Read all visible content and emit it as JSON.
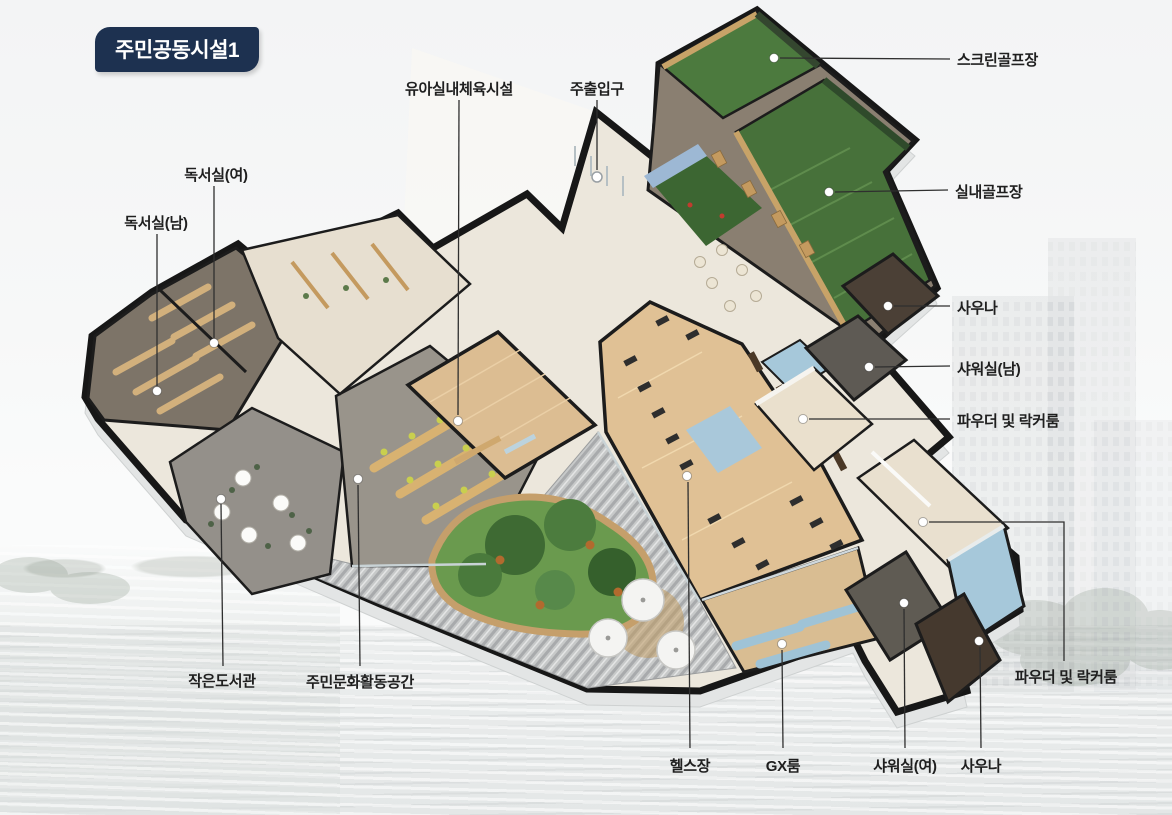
{
  "title_badge": {
    "text": "주민공동시설1",
    "bg_color": "#1d3150",
    "text_color": "#ffffff"
  },
  "facility_labels": {
    "infant_indoor_gym": "유아실내체육시설",
    "main_entrance": "주출입구",
    "screen_golf": "스크린골프장",
    "indoor_golf": "실내골프장",
    "sauna_upper": "사우나",
    "shower_room_men": "샤워실(남)",
    "powder_locker_room_upper": "파우더 및 락커룸",
    "reading_room_women": "독서실(여)",
    "reading_room_men": "독서실(남)",
    "small_library": "작은도서관",
    "community_culture_space": "주민문화활동공간",
    "fitness_center": "헬스장",
    "gx_room": "GX룸",
    "shower_room_women": "샤워실(여)",
    "sauna_lower": "사우나",
    "powder_locker_room_lower": "파우더 및 락커룸"
  },
  "colors": {
    "badge_navy": "#1d3150",
    "screen_golf_green": "#4c7a3e",
    "golf_turf_green": "#47713a",
    "putting_green": "#3c6632",
    "gym_wood": "#e0c195",
    "infant_gym_wood": "#dcbd92",
    "gx_wood": "#d9bd92",
    "pool_blue": "#a6c8da",
    "mat_blue": "#a9c8da",
    "sauna_brown": "#4b4036",
    "sauna_brown_dark": "#45392e",
    "shower_gray": "#5e5a54",
    "lounge_carpet": "#8a7f71",
    "reading_carpet": "#7d7468",
    "common_floor": "#ece7dc",
    "deck_gray": "#c7c9c9",
    "activity_floor_gray": "#99948b",
    "library_floor_gray": "#94908a",
    "garden_green": "#6a9a4e",
    "wood_partition": "#c8a368",
    "label_text": "#1f1f1f"
  }
}
